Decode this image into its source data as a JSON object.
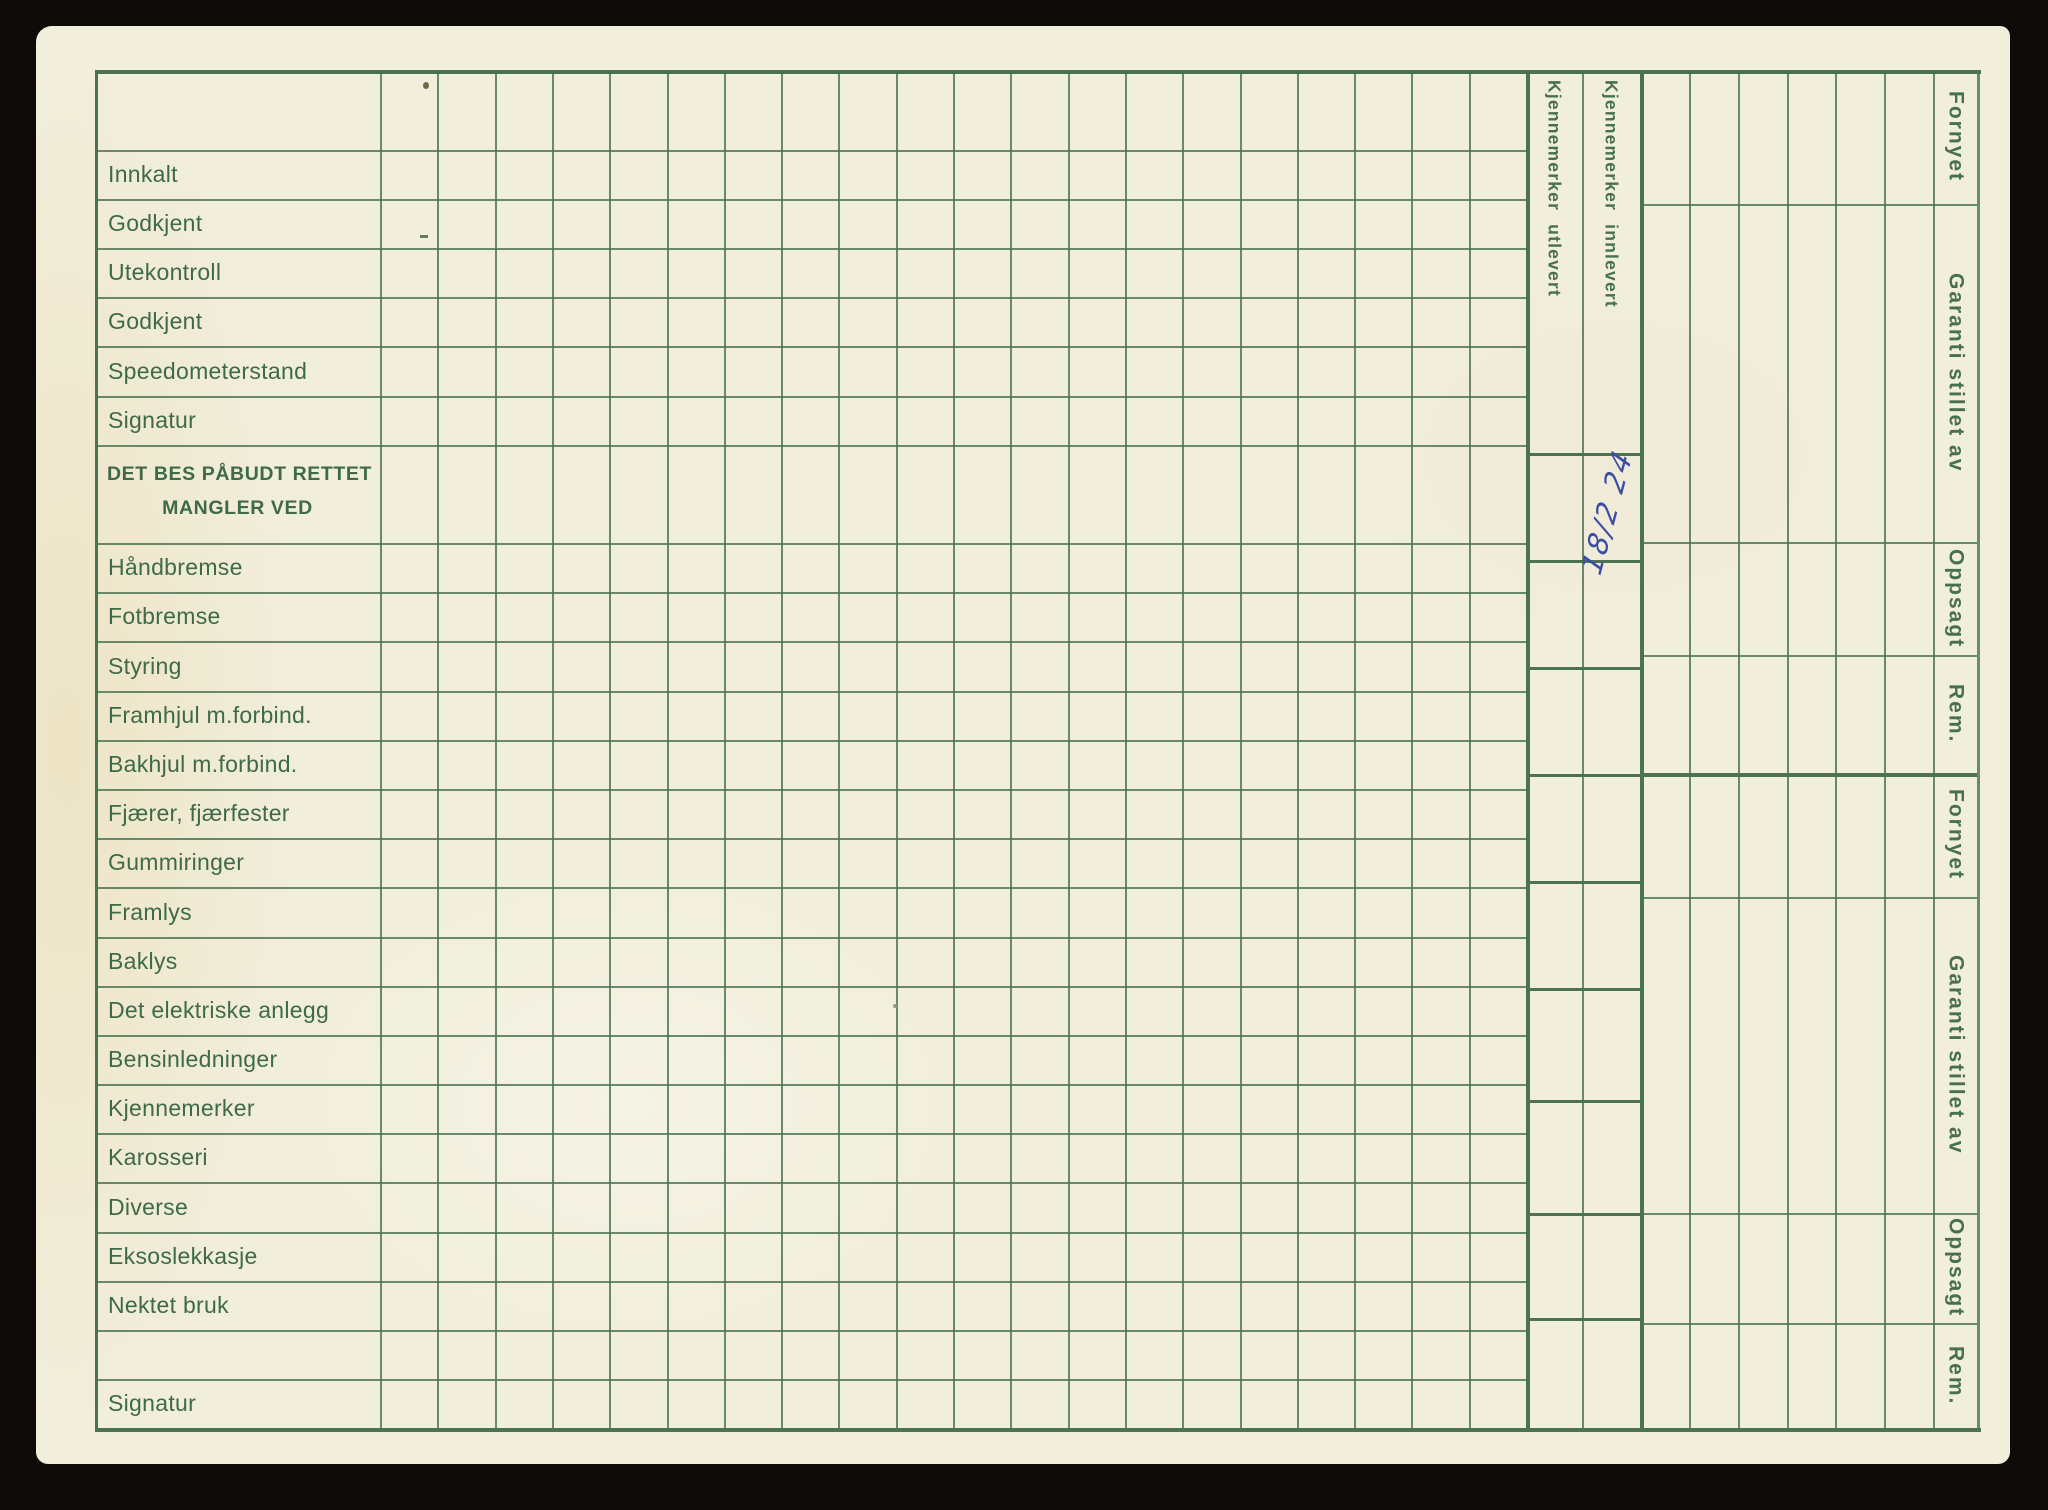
{
  "colors": {
    "paper": "#f1eedc",
    "grid_line": "#4b7352",
    "label_text": "#3e6a49",
    "handwriting_ink": "#3c4da4",
    "background": "#0c0b08"
  },
  "left_column": {
    "rows": [
      "Innkalt",
      "Godkjent",
      "Utekontroll",
      "Godkjent",
      "Speedometerstand",
      "Signatur"
    ],
    "defects_header": {
      "line1": "DET BES PÅBUDT RETTET",
      "line2": "MANGLER VED"
    },
    "defect_rows": [
      "Håndbremse",
      "Fotbremse",
      "Styring",
      "Framhjul m.forbind.",
      "Bakhjul m.forbind.",
      "Fjærer, fjærfester",
      "Gummiringer",
      "Framlys",
      "Baklys",
      "Det elektriske anlegg",
      "Bensinledninger",
      "Kjennemerker",
      "Karosseri",
      "Diverse",
      "Eksoslekkasje",
      "Nektet bruk"
    ],
    "bottom_row": "Signatur"
  },
  "plate_columns": {
    "out": "Kjennemerker utlevert",
    "in": "Kjennemerker innlevert"
  },
  "right_labels": {
    "top": [
      "Fornyet",
      "Garanti stillet av",
      "Oppsagt",
      "Rem."
    ],
    "bottom": [
      "Fornyet",
      "Garanti stillet av",
      "Oppsagt",
      "Rem."
    ]
  },
  "handwriting": {
    "date": "18/2 24"
  }
}
